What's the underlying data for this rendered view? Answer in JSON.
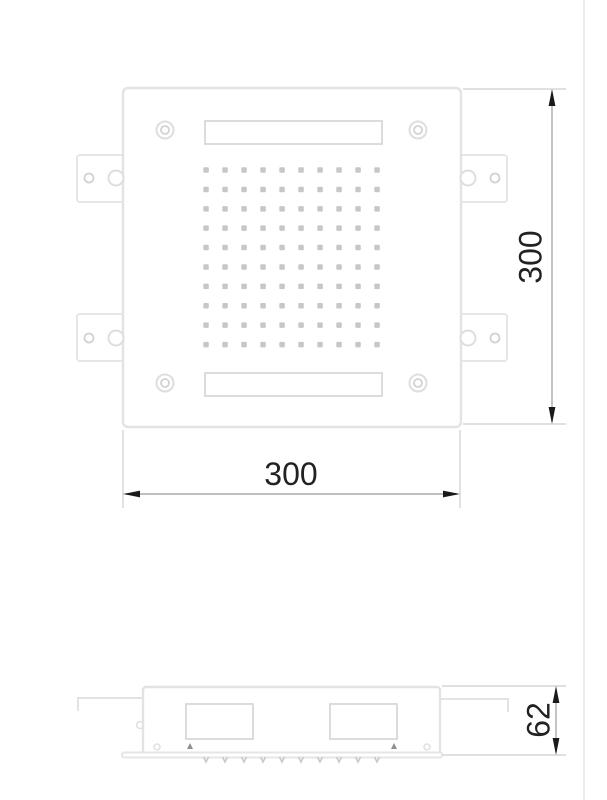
{
  "drawing": {
    "type": "technical-drawing",
    "component": "square-ceiling-shower-head",
    "views": {
      "plan": {
        "name": "plan-view"
      },
      "side": {
        "name": "side-view"
      }
    },
    "dimensions": {
      "height": {
        "label": "300"
      },
      "width": {
        "label": "300"
      },
      "depth": {
        "label": "62"
      }
    },
    "nozzle_grid": {
      "rows": 10,
      "cols": 10,
      "x0": 206,
      "y0": 170,
      "dx": 19.0,
      "dy": 19.4,
      "size": 5.5,
      "color": "#c7c7c7"
    },
    "side_ticks": {
      "count": 10,
      "x0": 206,
      "dx": 19.0,
      "y": 757,
      "size": 5,
      "color": "#c9c9c9"
    },
    "colors": {
      "outline": "#e3e3e3",
      "slot": "#d9d9d9",
      "nozzle": "#c7c7c7",
      "extension_line": "#d6d6d6",
      "dimension_line": "#ababab",
      "arrow": "#1a1a1a",
      "text": "#222222",
      "page_border": "#ededed"
    }
  }
}
